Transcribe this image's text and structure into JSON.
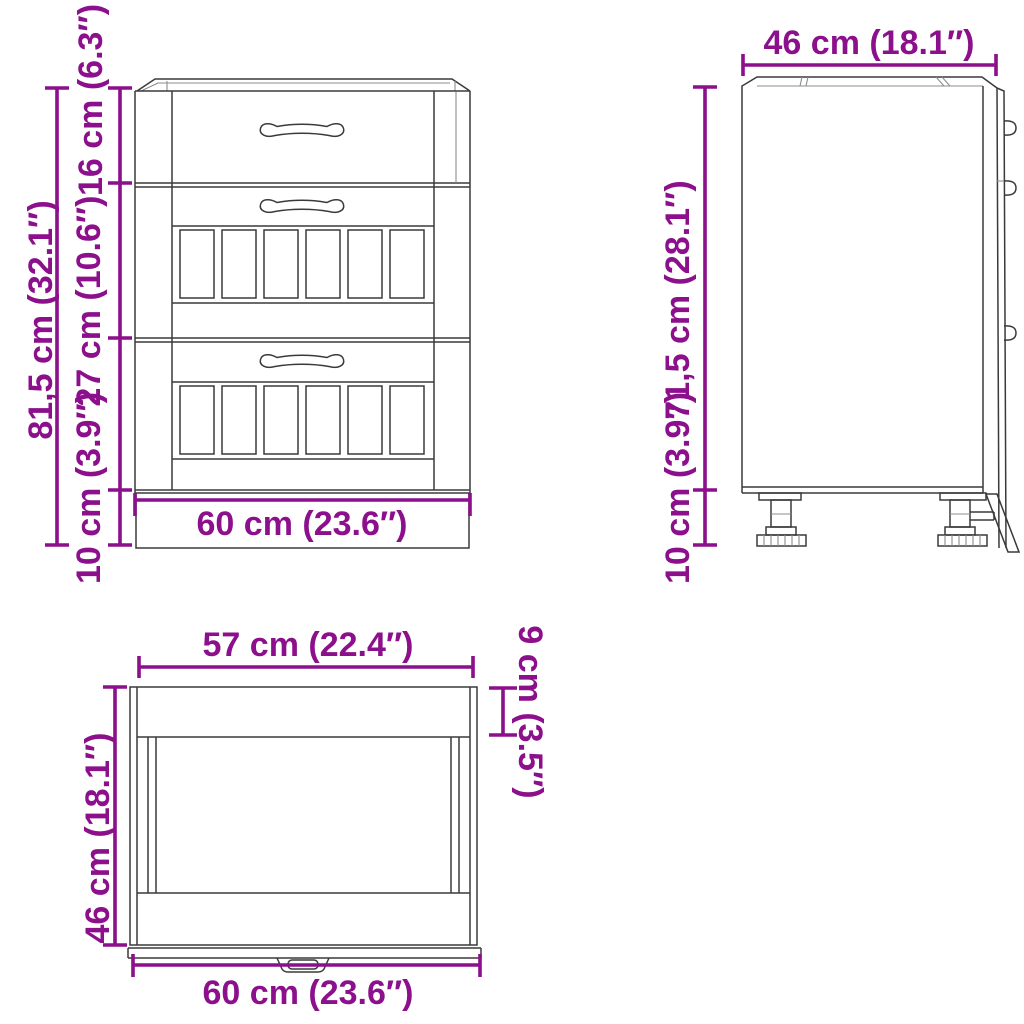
{
  "image": {
    "type": "product dimension diagram",
    "subject": "kitchen base cabinet with three drawers, side view and top view",
    "background": "#ffffff"
  },
  "colors": {
    "dimension": "#8C0F8C",
    "line": "#3a3a3a",
    "line_light": "#8d8d8d"
  },
  "views": {
    "front": {
      "labels": {
        "total_height": "81,5 cm (32.1″)",
        "top_drawer_height": "16 cm (6.3″)",
        "drawer_height": "27 cm (10.6″)",
        "plinth_height": "10 cm (3.9″)",
        "width": "60 cm (23.6″)"
      }
    },
    "side": {
      "labels": {
        "depth": "46 cm (18.1″)",
        "carcass_height": "71,5 cm (28.1″)",
        "leg_height": "10 cm (3.9″)"
      }
    },
    "top": {
      "labels": {
        "inner_width": "57 cm (22.4″)",
        "top_rail_depth": "9 cm (3.5″)",
        "depth": "46 cm (18.1″)",
        "width": "60 cm (23.6″)"
      }
    }
  }
}
